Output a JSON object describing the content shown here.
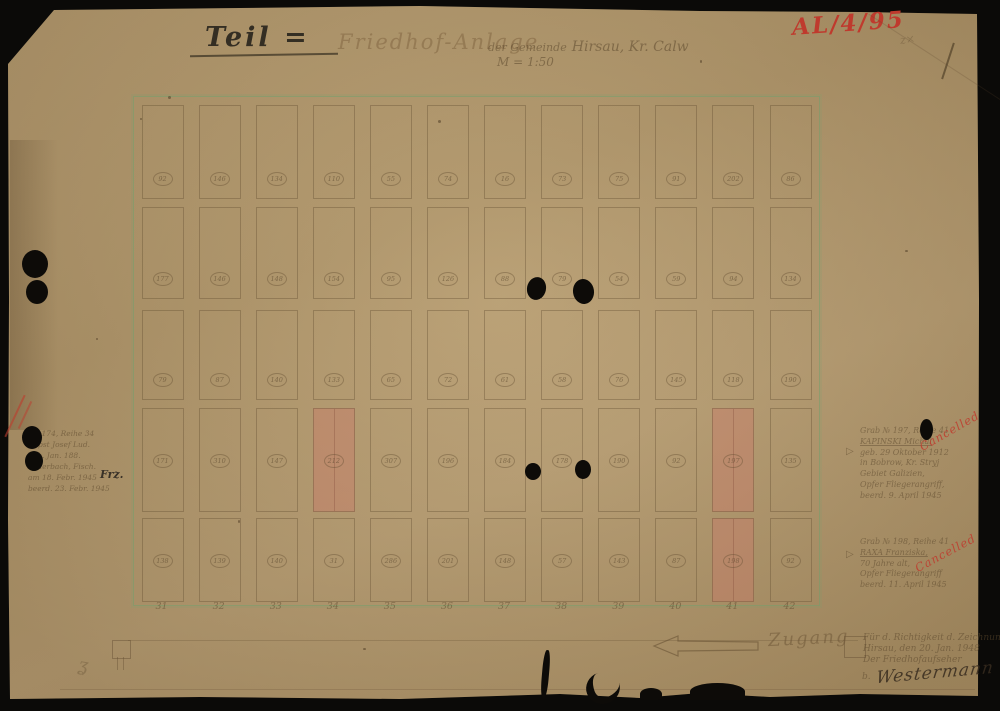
{
  "document": {
    "ref_number": "AL/4/95",
    "title_prefix": "Teil =",
    "title_main": "Friedhof-Anlage",
    "title_gemeinde": "der Gemeinde",
    "title_place": "Hirsau, Kr. Calw",
    "scale": "M = 1:50",
    "corner_mark": "z×",
    "squiggle_mark": "ʓ",
    "access_label": "Zugang"
  },
  "grid": {
    "column_labels": [
      "31",
      "32",
      "33",
      "34",
      "35",
      "36",
      "37",
      "38",
      "39",
      "40",
      "41",
      "42"
    ],
    "rows": [
      [
        "92",
        "146",
        "134",
        "110",
        "55",
        "74",
        "16",
        "73",
        "75",
        "91",
        "202",
        "86"
      ],
      [
        "177",
        "146",
        "148",
        "154",
        "95",
        "126",
        "88",
        "79",
        "54",
        "59",
        "94",
        "134"
      ],
      [
        "79",
        "87",
        "140",
        "133",
        "65",
        "72",
        "61",
        "58",
        "76",
        "145",
        "118",
        "190"
      ],
      [
        "171",
        "310",
        "147",
        "212",
        "307",
        "196",
        "184",
        "178",
        "190",
        "92",
        "197",
        "135"
      ],
      [
        "138",
        "139",
        "140",
        "31",
        "286",
        "201",
        "148",
        "57",
        "143",
        "87",
        "198",
        "92"
      ]
    ],
    "highlights": [
      {
        "r": 3,
        "c": 3
      },
      {
        "r": 3,
        "c": 10
      },
      {
        "r": 4,
        "c": 10
      }
    ]
  },
  "annotations": {
    "left": {
      "lines": [
        "Gr. 174, Reihe 34",
        "Bopst Josef Lud.",
        "geb. Jan. 188.",
        "Feuerbach, Fisch.",
        "am 18. Febr. 1945",
        "beerd. 23. Febr. 1945"
      ],
      "ink_note": "Frz."
    },
    "grave197": {
      "lines": [
        "Grab № 197, Reihe 41",
        "KAPINSKI Michal",
        "geb. 29 Oktober 1912",
        "in Bobrow, Kr. Stryj",
        "Gebiet Galizien,",
        "Opfer Fliegerangriff,",
        "beerd. 9. April 1945"
      ],
      "stamp": "Cancelled",
      "pointer": "▷"
    },
    "grave198": {
      "lines": [
        "Grab № 198, Reihe 41",
        "RAXA Franziska,",
        "70 Jahre alt,",
        "Opfer Fliegerangriff",
        "beerd. 11. April 1945"
      ],
      "stamp": "Cancelled",
      "pointer": "▷"
    },
    "certification": {
      "lines": [
        "Für d. Richtigkeit d. Zeichnung",
        "Hirsau, den 20. Jan. 1948",
        "Der Friedhofaufseher"
      ],
      "signature_prefix": "b.",
      "signature": "Westermann"
    }
  }
}
